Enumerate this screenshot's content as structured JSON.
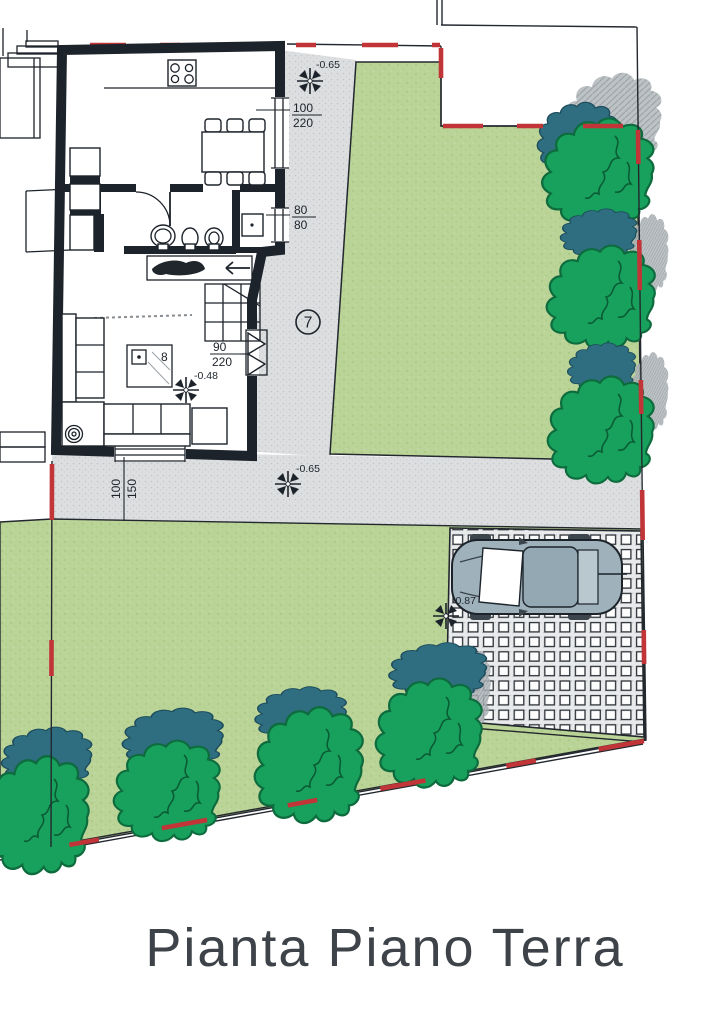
{
  "title": "Pianta Piano Terra",
  "annotations": {
    "room_number": "7",
    "furniture_number": "8",
    "levels": {
      "garden_path_upper": "-0.65",
      "garden_path_lower": "-0.65",
      "living_room": "-0.48",
      "parking": "-0.87"
    },
    "dimensions": {
      "kitchen_window": {
        "width": "100",
        "height": "220"
      },
      "bathroom_window": {
        "width": "80",
        "height": "80"
      },
      "entry_door": {
        "width": "90",
        "height": "220"
      },
      "living_room_window": {
        "width": "100",
        "height": "150"
      }
    }
  },
  "colors": {
    "ink": "#1d232a",
    "red": "#c13437",
    "lawn": "#bad397",
    "tree": "#18a15c",
    "teal": "#2e6e80",
    "shadow": "#aeb4b8",
    "path": "#dcdee0",
    "paver": "#e9eaeb",
    "car": "#9fb2bb",
    "title_color": "#3d4349"
  }
}
